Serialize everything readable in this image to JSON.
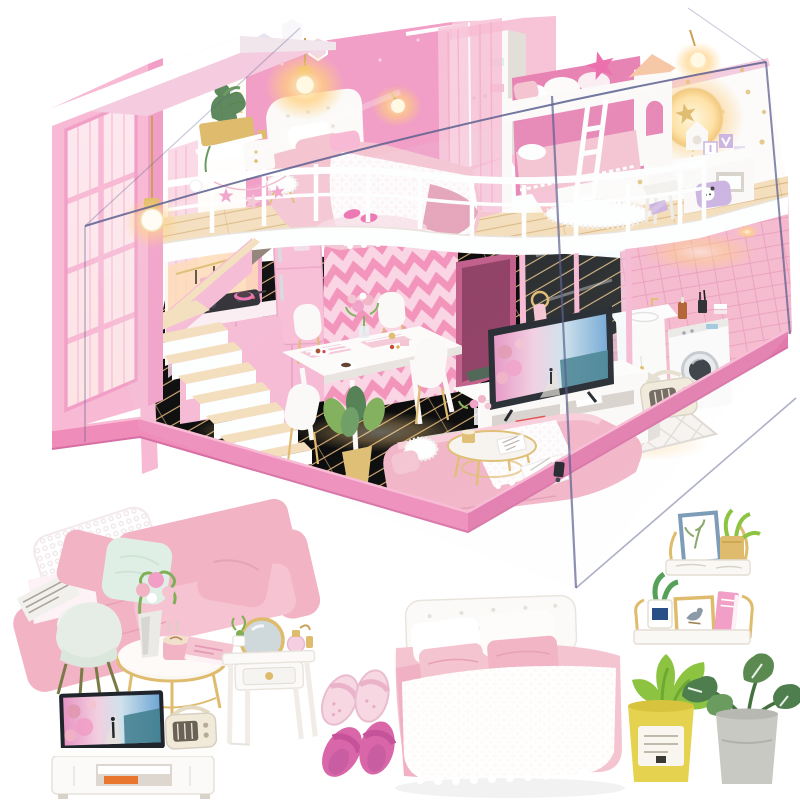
{
  "image": {
    "type": "product-photo",
    "subject": "DIY miniature dollhouse kit - pink two-story loft apartment displayed in a clear acrylic dust cover, with close-up shots of the miniature furniture below",
    "width": 800,
    "height": 800
  },
  "palette": {
    "background": "#ffffff",
    "furniture_white": "#fbfaf8",
    "furniture_shadow": "#e3ded8",
    "wall_pink": "#f7b9d3",
    "wall_pink_deep": "#f19fc6",
    "wall_rose": "#e784b4",
    "chevron_light": "#fbd4e3",
    "chevron_stripe": "#f48fb8",
    "roof_pink": "#f4cbdf",
    "white_wall": "#fdfcfb",
    "gold": "#c09a4a",
    "gold_light": "#dfbc6d",
    "wood": "#eac档8c",
    "wood_dark": "#d3a76c",
    "wood_light": "#f4debA",
    "base_pink": "#ef8cba",
    "acrylic_edge": "#5c6090",
    "glow_core": "#fff7dc",
    "glow_warm": "#ffcf7e",
    "sofa_pink": "#f2b3c5",
    "sofa_pink_deep": "#e298af",
    "mint": "#e0efe6",
    "hot_pink": "#ec6fae",
    "duvet_pink": "#f5c4d1",
    "slipper_pale": "#f6d7e2",
    "slipper_pink": "#d966a9",
    "leaf_green": "#7fae56",
    "leaf_dark": "#4e7d4e",
    "pot_yellow": "#e5d34f",
    "pot_gray": "#c9c9c3",
    "tile_pink": "#f6b8cc",
    "radio_cream": "#f1ead9",
    "frame_blue": "#7d9cb8",
    "screen_blue": "#6fa6d4",
    "screen_pink": "#e794c4",
    "dark_frame": "#20242b"
  },
  "dollhouse": {
    "rooms": [
      "loft-master-bedroom",
      "kids-bunk-corner",
      "stair-void-window",
      "kitchen-under-stairs",
      "dining-area",
      "living-room",
      "laundry-bathroom"
    ],
    "furniture": [
      "double-bed-crochet-blanket",
      "white-tufted-headboard",
      "bunk-bed-with-ladder",
      "house-shaped-post",
      "wardrobe",
      "kids-desk-chair",
      "moon-wall-lamp",
      "gold-star-decals",
      "pendant-bulb-lamps",
      "gold-planter-box",
      "hexagon-wall-decor",
      "framed-art",
      "loft-railing-star-banner",
      "two-flight-staircase",
      "pink-kitchen-cabinets",
      "cooktop-with-pots",
      "retro-pink-fridge",
      "chevron-wallpaper",
      "wall-shelves",
      "dining-table-four-chairs",
      "plates-of-food",
      "peony-centerpiece",
      "gold-potted-plant",
      "diamond-rug",
      "tv-media-console",
      "flatscreen-tv",
      "retro-radio",
      "pink-sofa-knit-throw",
      "gold-coffee-table",
      "glass-partition",
      "sink-cabinet",
      "front-load-washing-machine",
      "acrylic-display-case",
      "pink-display-base"
    ]
  },
  "detail_items": [
    "pink-sectional-sofa-with-mint-and-pink-pillows-lace-throw-magazine",
    "white-shell-side-chair",
    "gold-round-coffee-table-with-flower-vase-latte-cup-pink-book",
    "flatscreen-tv-on-white-media-console-with-retro-radio-and-orange-book",
    "white-vanity-with-round-gold-mirror-perfume-bottles-gold-knob-drawer",
    "pale-pink-lace-slippers-pair",
    "dark-pink-slippers-pair",
    "double-bed-white-tufted-headboard-pink-bedding-white-crochet-coverlet",
    "gold-bracket-wall-shelf-with-blue-botanical-frame-and-gold-pot-plant",
    "white-wall-shelf-with-potted-plant-bird-frame-and-pink-book",
    "green-plant-in-yellow-labeled-pot",
    "monstera-plant-in-gray-pot"
  ]
}
